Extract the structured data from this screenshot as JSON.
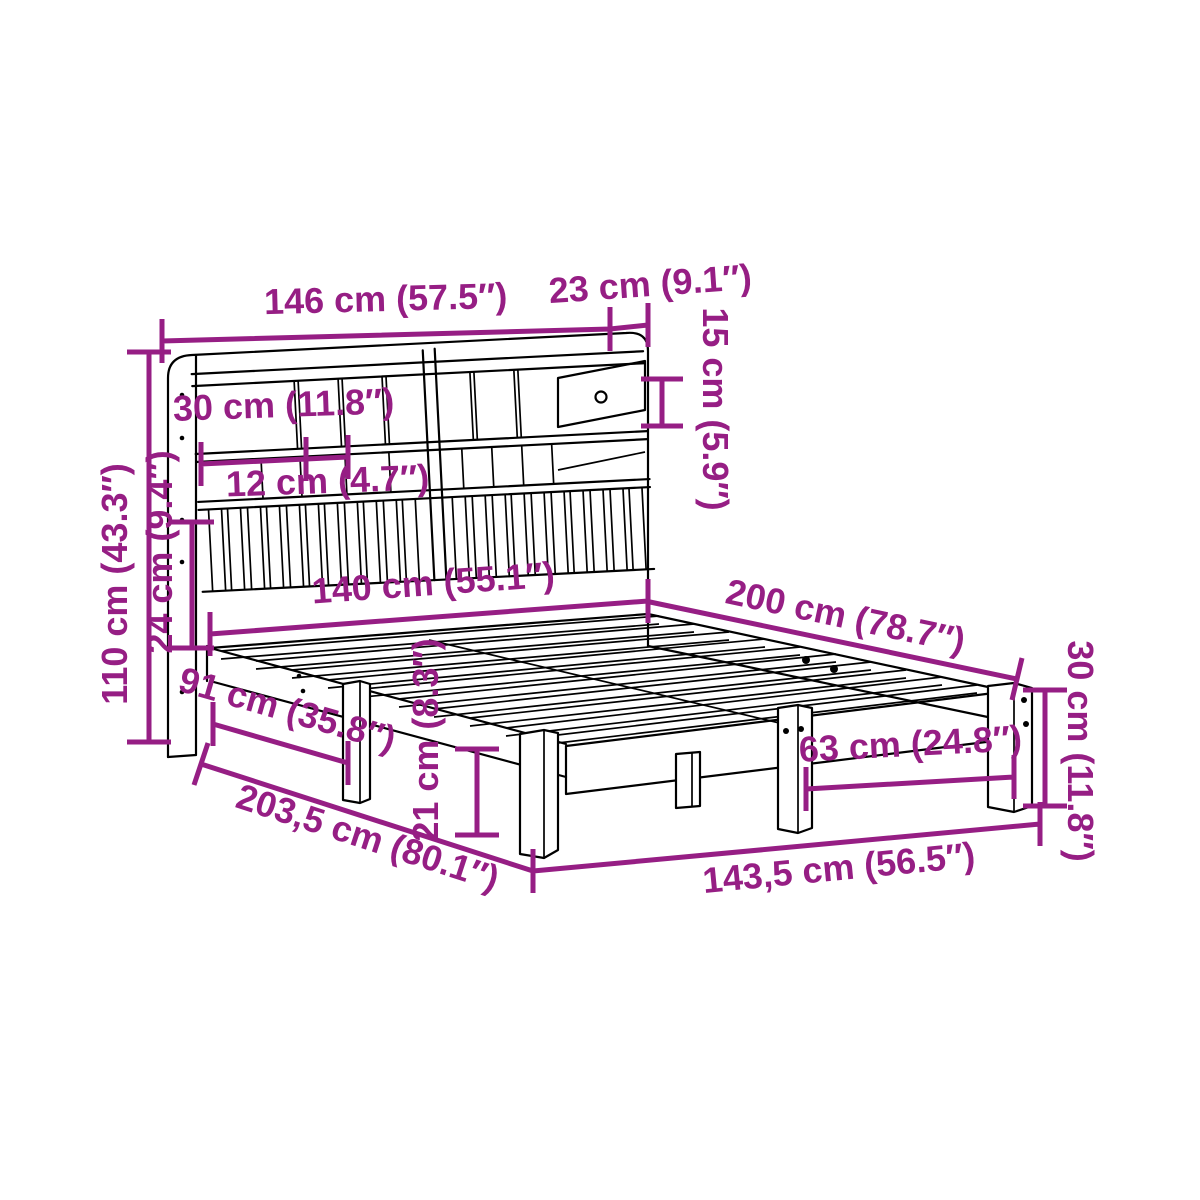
{
  "canvas": {
    "width": 1200,
    "height": 1200,
    "background": "#ffffff"
  },
  "colors": {
    "dimension": "#961E84",
    "drawing": "#000000"
  },
  "figure": {
    "name": "bookshelf-bed-line-drawing",
    "style": "perspective wireframe product diagram"
  },
  "dimensions": [
    {
      "id": "headboard-width",
      "label": "146 cm (57.5″)",
      "cm": 146,
      "inches": 57.5,
      "orientation": "horizontal-top"
    },
    {
      "id": "headboard-depth",
      "label": "23 cm (9.1″)",
      "cm": 23,
      "inches": 9.1,
      "orientation": "horizontal-top-right"
    },
    {
      "id": "drawer-height",
      "label": "15 cm (5.9″)",
      "cm": 15,
      "inches": 5.9,
      "orientation": "vertical-right-of-headboard"
    },
    {
      "id": "shelf-width",
      "label": "30 cm (11.8″)",
      "cm": 30,
      "inches": 11.8,
      "orientation": "horizontal-on-headboard"
    },
    {
      "id": "shelf-gap",
      "label": "12 cm (4.7″)",
      "cm": 12,
      "inches": 4.7,
      "orientation": "horizontal-on-headboard"
    },
    {
      "id": "headboard-height",
      "label": "110 cm (43.3″)",
      "cm": 110,
      "inches": 43.3,
      "orientation": "vertical-left"
    },
    {
      "id": "slat-panel-height",
      "label": "24 cm (9.4″)",
      "cm": 24,
      "inches": 9.4,
      "orientation": "vertical-left"
    },
    {
      "id": "bed-width",
      "label": "140 cm (55.1″)",
      "cm": 140,
      "inches": 55.1,
      "orientation": "horizontal-middle"
    },
    {
      "id": "bed-length",
      "label": "200 cm (78.7″)",
      "cm": 200,
      "inches": 78.7,
      "orientation": "diagonal-right"
    },
    {
      "id": "leg-spacing-side",
      "label": "91 cm (35.8″)",
      "cm": 91,
      "inches": 35.8,
      "orientation": "diagonal-left"
    },
    {
      "id": "clearance-height",
      "label": "21 cm (8.3″)",
      "cm": 21,
      "inches": 8.3,
      "orientation": "vertical-middle"
    },
    {
      "id": "total-length",
      "label": "203,5 cm (80.1″)",
      "cm": 203.5,
      "inches": 80.1,
      "orientation": "diagonal-bottom-left"
    },
    {
      "id": "leg-spacing-foot",
      "label": "63 cm (24.8″)",
      "cm": 63,
      "inches": 24.8,
      "orientation": "horizontal-bottom"
    },
    {
      "id": "total-width",
      "label": "143,5 cm (56.5″)",
      "cm": 143.5,
      "inches": 56.5,
      "orientation": "horizontal-bottom"
    },
    {
      "id": "frame-height",
      "label": "30 cm (11.8″)",
      "cm": 30,
      "inches": 11.8,
      "orientation": "vertical-right"
    }
  ]
}
